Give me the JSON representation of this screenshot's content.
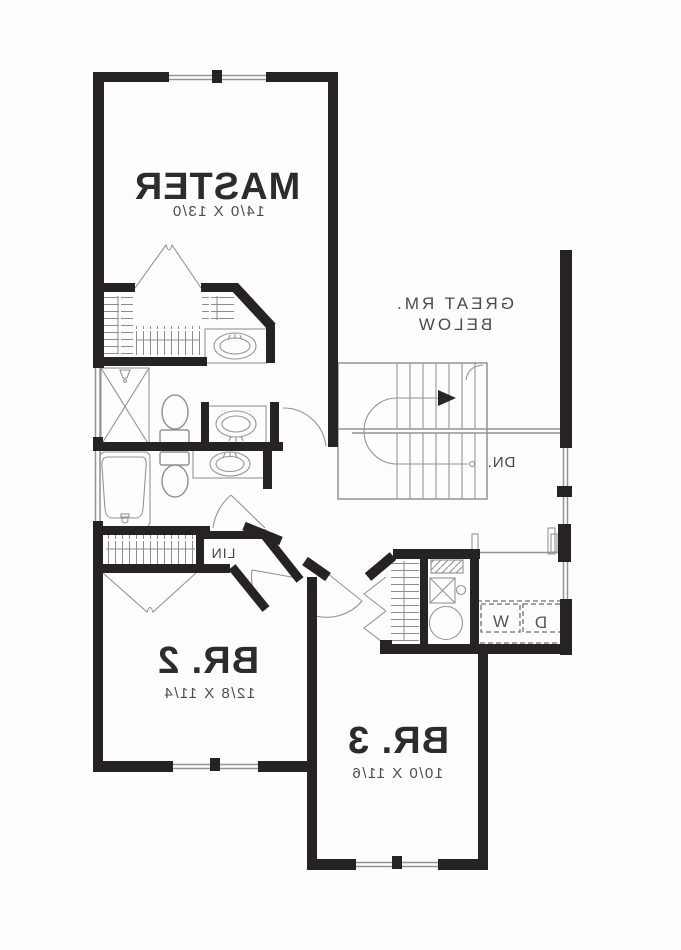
{
  "floor_plan": {
    "text_mirrored": true,
    "style": {
      "wall_color": "#272324",
      "line_color": "#949494",
      "text_color": "#2e2b2c",
      "dim_color": "#4b4b4b",
      "bg_color": "#fdfdfd"
    },
    "rooms": [
      {
        "name": "master-bedroom",
        "label": "MASTER",
        "dims": "14/0 X 13/0"
      },
      {
        "name": "great-room-open-below",
        "label": "GREAT RM.",
        "sublabel": "BELOW"
      },
      {
        "name": "bedroom-2",
        "label": "BR. 2",
        "dims": "12/8 X 11/4"
      },
      {
        "name": "bedroom-3",
        "label": "BR. 3",
        "dims": "10/0 X 11/6"
      }
    ],
    "labels": {
      "stair_down": "DN.",
      "linen_closet": "LIN",
      "washer": "W",
      "dryer": "D"
    },
    "icons": {
      "stairs": "stairs-icon",
      "stair_direction": "arrow-right-icon",
      "toilet": "toilet-icon",
      "sink": "sink-oval-icon",
      "bathtub": "bathtub-icon",
      "shower": "shower-x-icon",
      "water_heater": "water-heater-circle-icon",
      "furnace": "furnace-x-box-icon",
      "closet_rod": "closet-hatch-icon",
      "door_swing": "door-arc-icon",
      "window": "double-line-window-icon"
    }
  }
}
